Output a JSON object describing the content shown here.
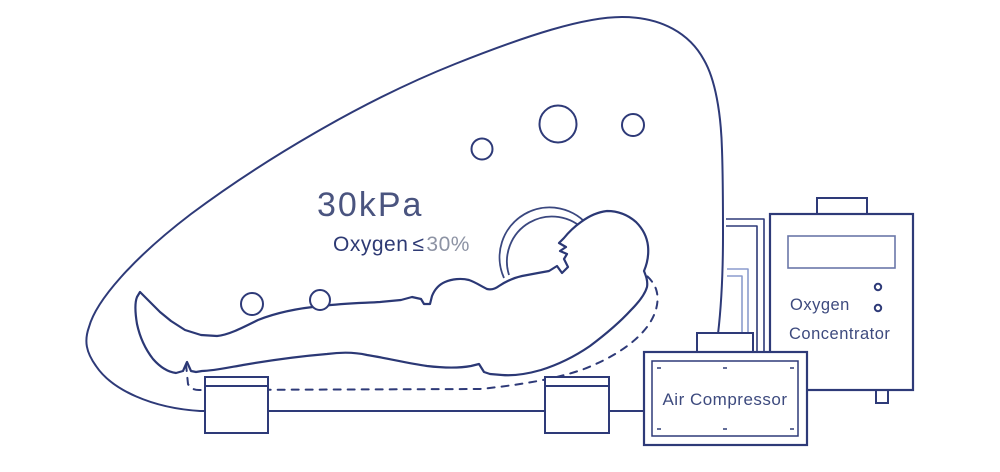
{
  "diagram": {
    "type": "hyperbaric-oxygen-chamber-schematic",
    "chamber": {
      "pressure": "30kPa",
      "oxygen_prefix": "Oxygen",
      "leq_symbol": "≤",
      "oxygen_limit": "30%"
    },
    "devices": {
      "air_compressor": {
        "label": "Air Compressor"
      },
      "oxygen_concentrator": {
        "label_line1": "Oxygen",
        "label_line2": "Concentrator"
      }
    },
    "colors": {
      "line_navy": "#2e3a78",
      "pressure_text": "#4a547f",
      "oxygen_text": "#2e3a74",
      "limit_text": "#8d93a4",
      "light_pipe_blue": "#8b9ccd",
      "display_stroke": "#6a77a8",
      "background": "#ffffff"
    }
  }
}
